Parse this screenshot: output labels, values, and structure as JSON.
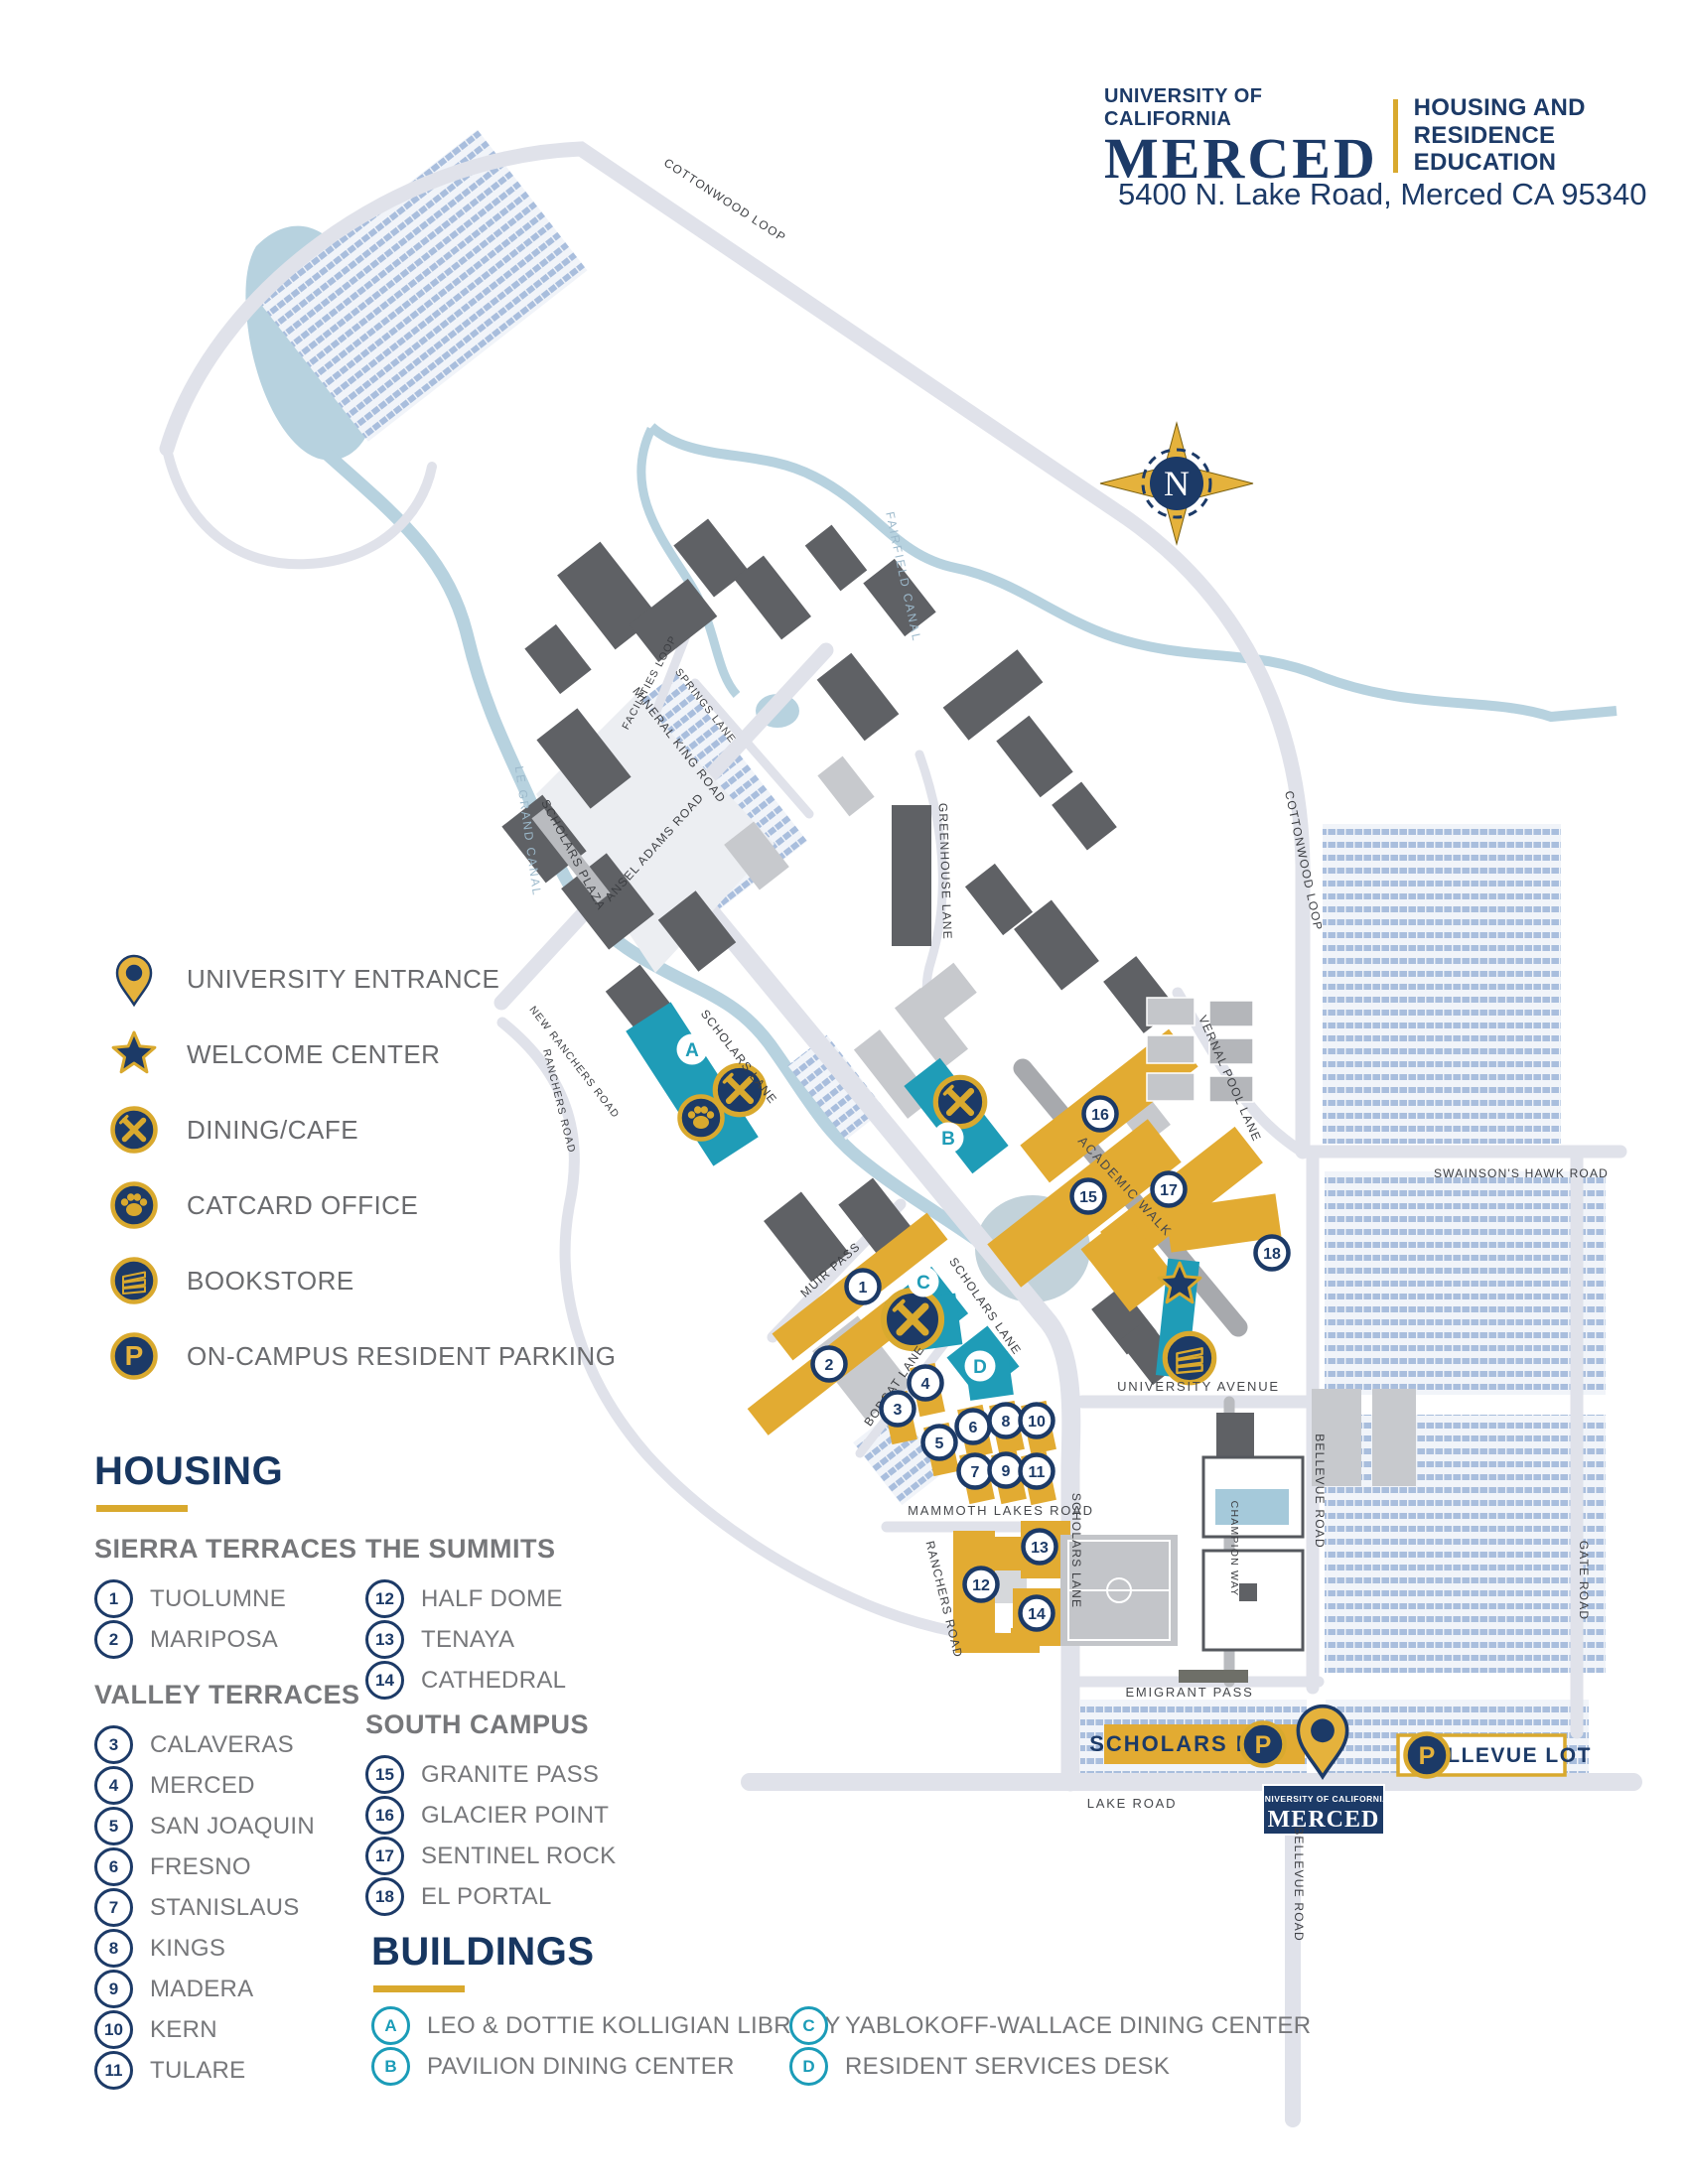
{
  "header": {
    "logo_line1": "UNIVERSITY OF CALIFORNIA",
    "logo_line2": "MERCED",
    "dept_line1": "HOUSING AND",
    "dept_line2": "RESIDENCE EDUCATION",
    "address": "5400 N. Lake Road, Merced CA 95340"
  },
  "icons": {
    "parking_letter": "P"
  },
  "legend": {
    "items": [
      {
        "icon": "entrance-pin-icon",
        "label": "UNIVERSITY ENTRANCE"
      },
      {
        "icon": "welcome-star-icon",
        "label": "WELCOME CENTER"
      },
      {
        "icon": "dining-icon",
        "label": "DINING/CAFE"
      },
      {
        "icon": "paw-icon",
        "label": "CATCARD OFFICE"
      },
      {
        "icon": "books-icon",
        "label": "BOOKSTORE"
      },
      {
        "icon": "parking-icon",
        "label": "ON-CAMPUS RESIDENT PARKING"
      }
    ]
  },
  "housing": {
    "title": "HOUSING",
    "sections": [
      {
        "name": "SIERRA TERRACES",
        "items": [
          {
            "num": "1",
            "label": "TUOLUMNE"
          },
          {
            "num": "2",
            "label": "MARIPOSA"
          }
        ]
      },
      {
        "name": "VALLEY TERRACES",
        "items": [
          {
            "num": "3",
            "label": "CALAVERAS"
          },
          {
            "num": "4",
            "label": "MERCED"
          },
          {
            "num": "5",
            "label": "SAN JOAQUIN"
          },
          {
            "num": "6",
            "label": "FRESNO"
          },
          {
            "num": "7",
            "label": "STANISLAUS"
          },
          {
            "num": "8",
            "label": "KINGS"
          },
          {
            "num": "9",
            "label": "MADERA"
          },
          {
            "num": "10",
            "label": "KERN"
          },
          {
            "num": "11",
            "label": "TULARE"
          }
        ]
      },
      {
        "name": "THE SUMMITS",
        "items": [
          {
            "num": "12",
            "label": "HALF DOME"
          },
          {
            "num": "13",
            "label": "TENAYA"
          },
          {
            "num": "14",
            "label": "CATHEDRAL"
          }
        ]
      },
      {
        "name": "SOUTH CAMPUS",
        "items": [
          {
            "num": "15",
            "label": "GRANITE PASS"
          },
          {
            "num": "16",
            "label": "GLACIER POINT"
          },
          {
            "num": "17",
            "label": "SENTINEL ROCK"
          },
          {
            "num": "18",
            "label": "EL PORTAL"
          }
        ]
      }
    ]
  },
  "buildings": {
    "title": "BUILDINGS",
    "items": [
      {
        "letter": "A",
        "label": "LEO & DOTTIE KOLLIGIAN LIBRARY"
      },
      {
        "letter": "B",
        "label": "PAVILION DINING CENTER"
      },
      {
        "letter": "C",
        "label": "YABLOKOFF-WALLACE DINING CENTER"
      },
      {
        "letter": "D",
        "label": "RESIDENT SERVICES DESK"
      }
    ]
  },
  "map": {
    "compass_letter": "N",
    "road_labels": [
      {
        "text": "COTTONWOOD LOOP"
      },
      {
        "text": "COTTONWOOD LOOP"
      },
      {
        "text": "FACILITIES LOOP"
      },
      {
        "text": "SPRINGS LANE"
      },
      {
        "text": "MINERAL KING ROAD"
      },
      {
        "text": "ANSEL ADAMS ROAD"
      },
      {
        "text": "SCHOLARS PLAZA"
      },
      {
        "text": "SCHOLARS LANE"
      },
      {
        "text": "SCHOLARS LANE"
      },
      {
        "text": "SCHOLARS LANE"
      },
      {
        "text": "GREENHOUSE LANE"
      },
      {
        "text": "VERNAL POOL LANE"
      },
      {
        "text": "NEW RANCHERS ROAD"
      },
      {
        "text": "RANCHERS ROAD"
      },
      {
        "text": "RANCHERS ROAD"
      },
      {
        "text": "MUIR PASS"
      },
      {
        "text": "BOBCAT LANE"
      },
      {
        "text": "ACADEMIC WALK"
      },
      {
        "text": "UNIVERSITY AVENUE"
      },
      {
        "text": "MAMMOTH LAKES ROAD"
      },
      {
        "text": "EMIGRANT PASS"
      },
      {
        "text": "LAKE ROAD"
      },
      {
        "text": "SWAINSON'S HAWK ROAD"
      },
      {
        "text": "BELLEVUE ROAD"
      },
      {
        "text": "BELLEVUE ROAD"
      },
      {
        "text": "GATE ROAD"
      },
      {
        "text": "CHAMPION WAY"
      },
      {
        "text": "LE GRAND CANAL"
      },
      {
        "text": "FAIRFIELD CANAL"
      }
    ],
    "markers": [
      {
        "label": "1"
      },
      {
        "label": "2"
      },
      {
        "label": "3"
      },
      {
        "label": "4"
      },
      {
        "label": "5"
      },
      {
        "label": "6"
      },
      {
        "label": "7"
      },
      {
        "label": "8"
      },
      {
        "label": "9"
      },
      {
        "label": "10"
      },
      {
        "label": "11"
      },
      {
        "label": "12"
      },
      {
        "label": "13"
      },
      {
        "label": "14"
      },
      {
        "label": "15"
      },
      {
        "label": "16"
      },
      {
        "label": "17"
      },
      {
        "label": "18"
      }
    ],
    "letter_markers": [
      {
        "label": "A"
      },
      {
        "label": "B"
      },
      {
        "label": "C"
      },
      {
        "label": "D"
      }
    ],
    "lots": {
      "scholars_label": "SCHOLARS LOT",
      "bellevue_label": "BELLEVUE LOT"
    },
    "entrance_sign": {
      "line1": "UNIVERSITY OF CALIFORNIA",
      "line2": "MERCED"
    }
  },
  "colors": {
    "navy": "#1c3a67",
    "gold": "#d9a92e",
    "teal": "#1f9cb7",
    "building_gray": "#5f6165",
    "road_gray": "#e0e2ea",
    "water_blue": "#b7d2df",
    "parking_hatch": "#a9bedd",
    "label_gray": "#6a6b6e"
  }
}
